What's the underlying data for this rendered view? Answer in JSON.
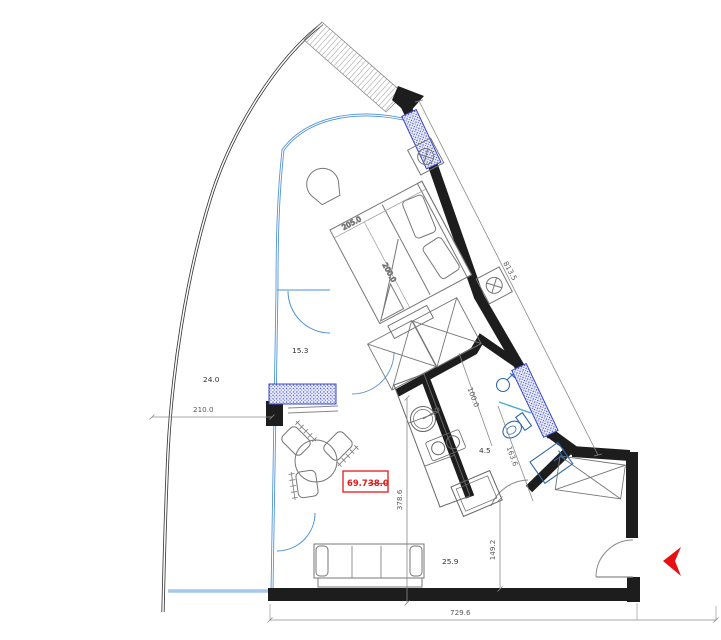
{
  "plan": {
    "title": "apartment-floor-plan",
    "rooms": {
      "balcony_area": "24.0",
      "bedroom_area": "15.3",
      "bathroom_area": "4.5",
      "living_area": "25.9"
    },
    "area_box": {
      "total_area": "69.7",
      "previous_area": "38.0"
    },
    "dims": {
      "balcony_width": "210.0",
      "bed_width": "205.0",
      "bed_length": "200.0",
      "facade_length": "813.5",
      "bath_width": "100.0",
      "bath_length": "163.6",
      "living_depth": "378.6",
      "entry_depth": "149.2",
      "overall_width": "729.6"
    },
    "colors": {
      "wall": "#1d1d1d",
      "glazing": "#4a90d9",
      "insulation": "#3b49c4",
      "dimension": "#6a6a6a",
      "accent_red": "#e51a1a"
    }
  }
}
